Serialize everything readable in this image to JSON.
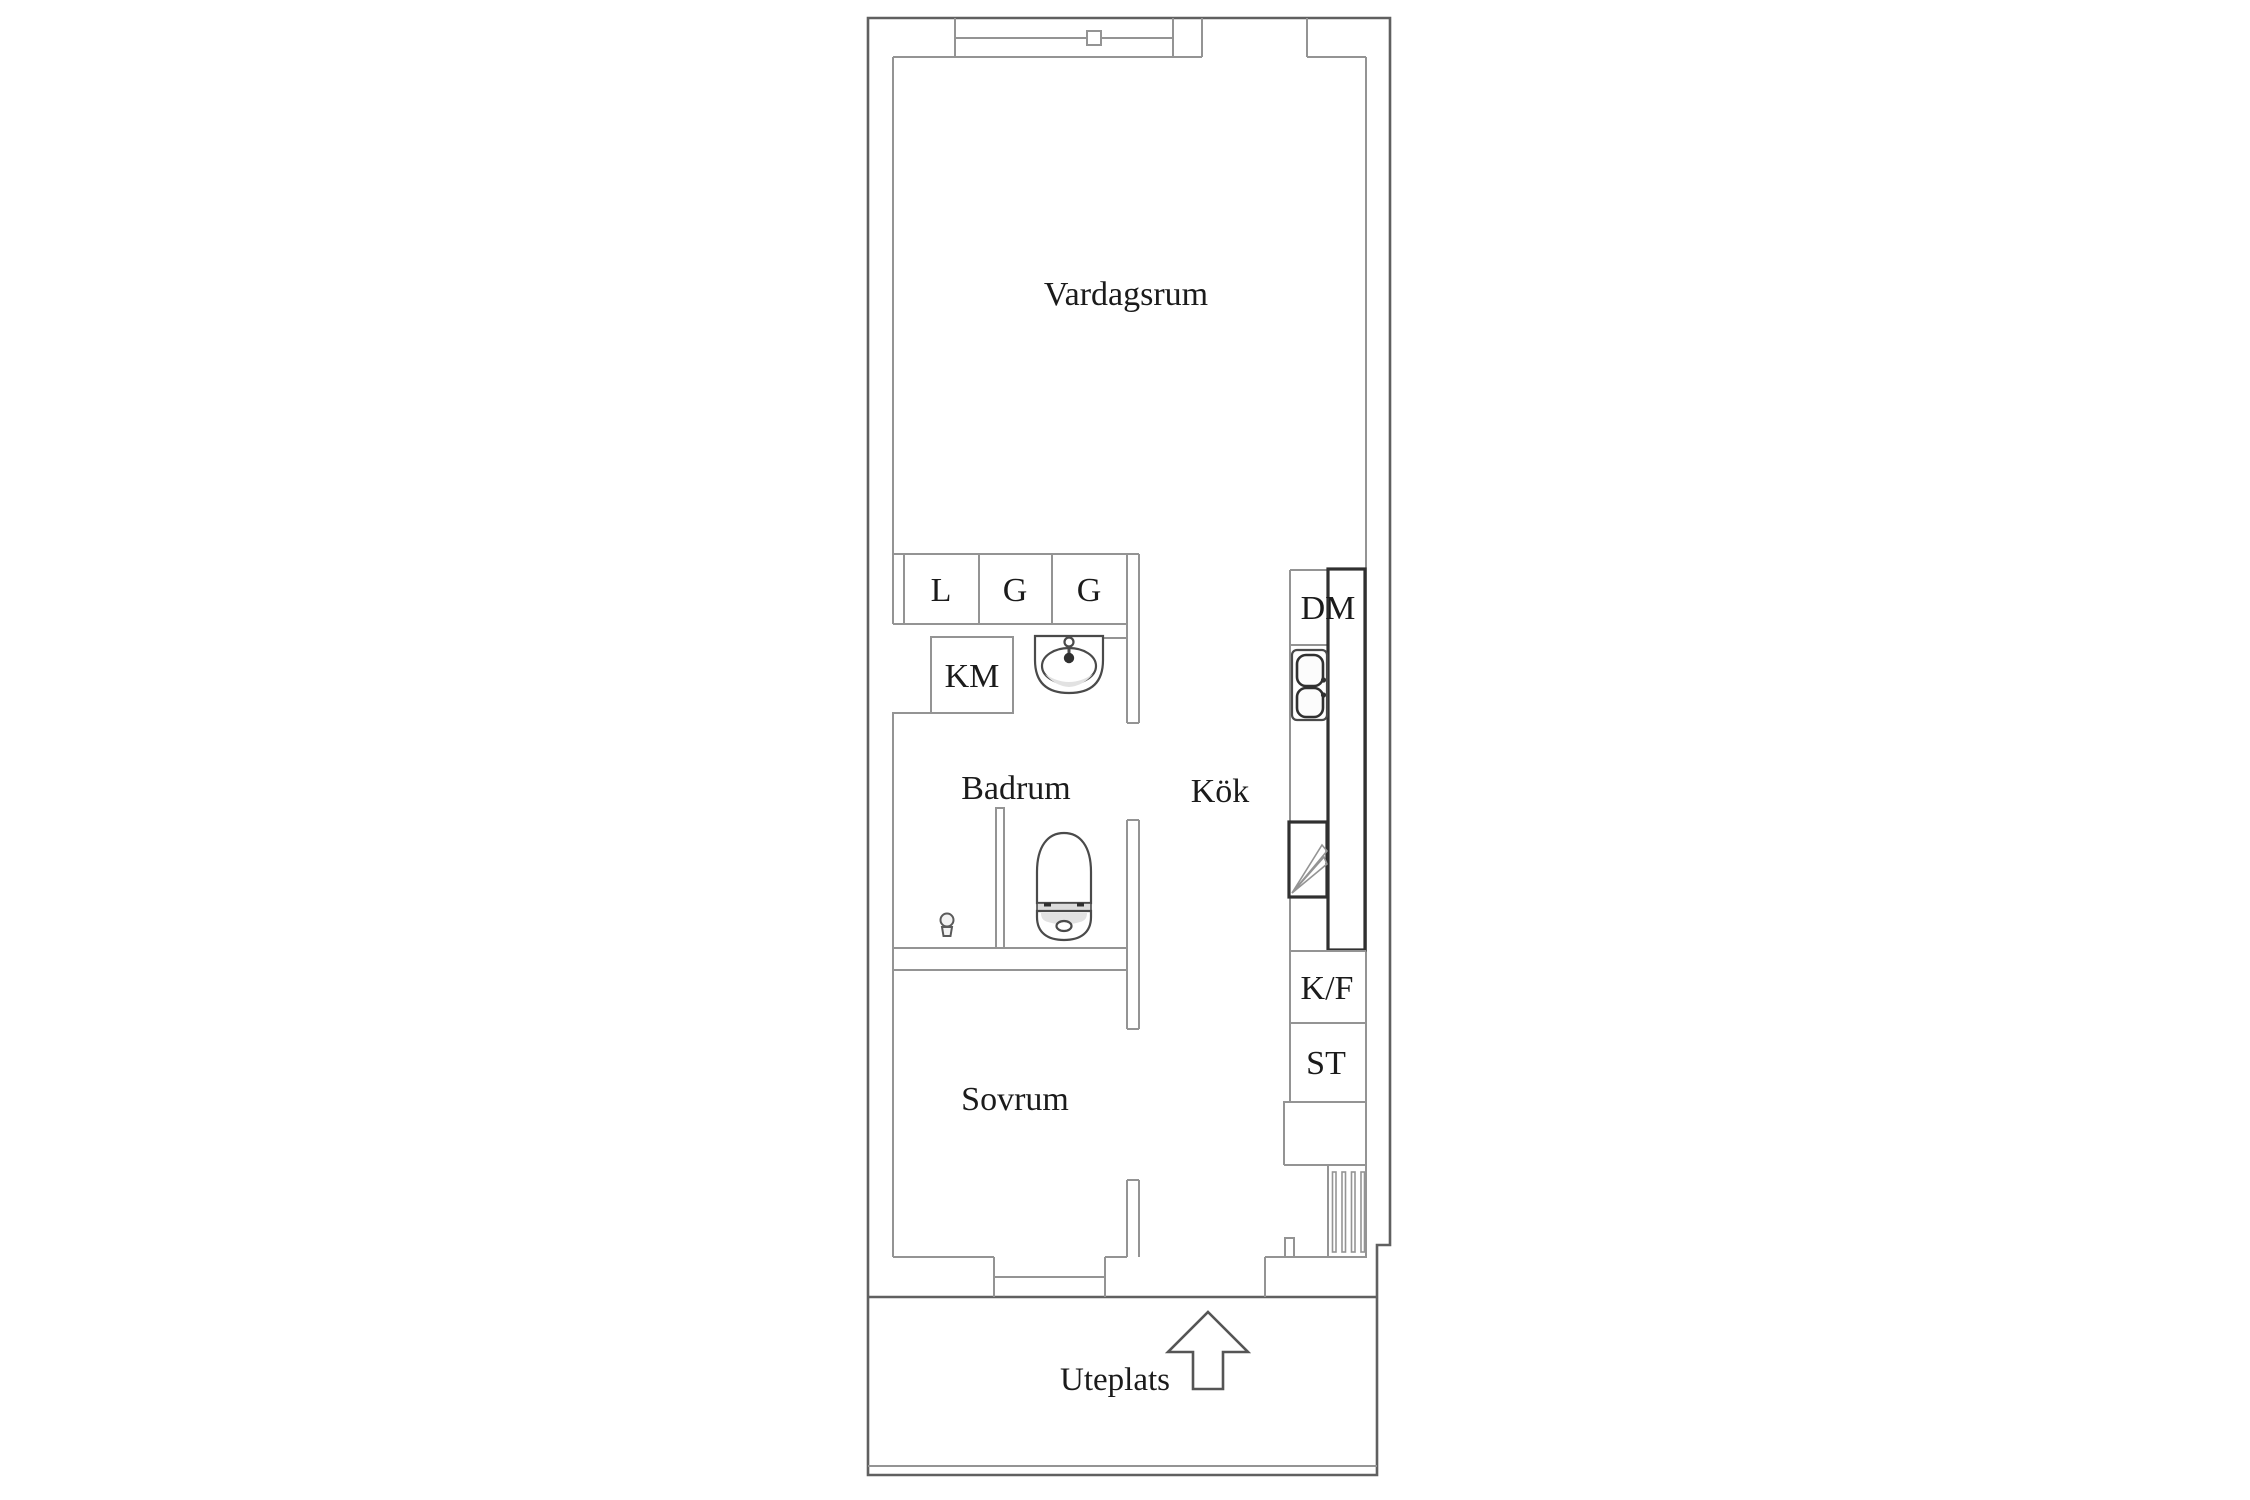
{
  "floorplan": {
    "rooms": {
      "living": "Vardagsrum",
      "bathroom": "Badrum",
      "kitchen": "Kök",
      "bedroom": "Sovrum",
      "patio": "Uteplats"
    },
    "fixtures": {
      "closet_linen": "L",
      "closet_wardrobe_1": "G",
      "closet_wardrobe_2": "G",
      "washing_machine": "KM",
      "dishwasher": "DM",
      "fridge_freezer": "K/F",
      "storage": "ST"
    },
    "colors": {
      "outer_wall": "#606060",
      "inner_wall": "#949494",
      "fixture_dark": "#303030",
      "text": "#1b1b1b",
      "background": "#ffffff"
    }
  }
}
